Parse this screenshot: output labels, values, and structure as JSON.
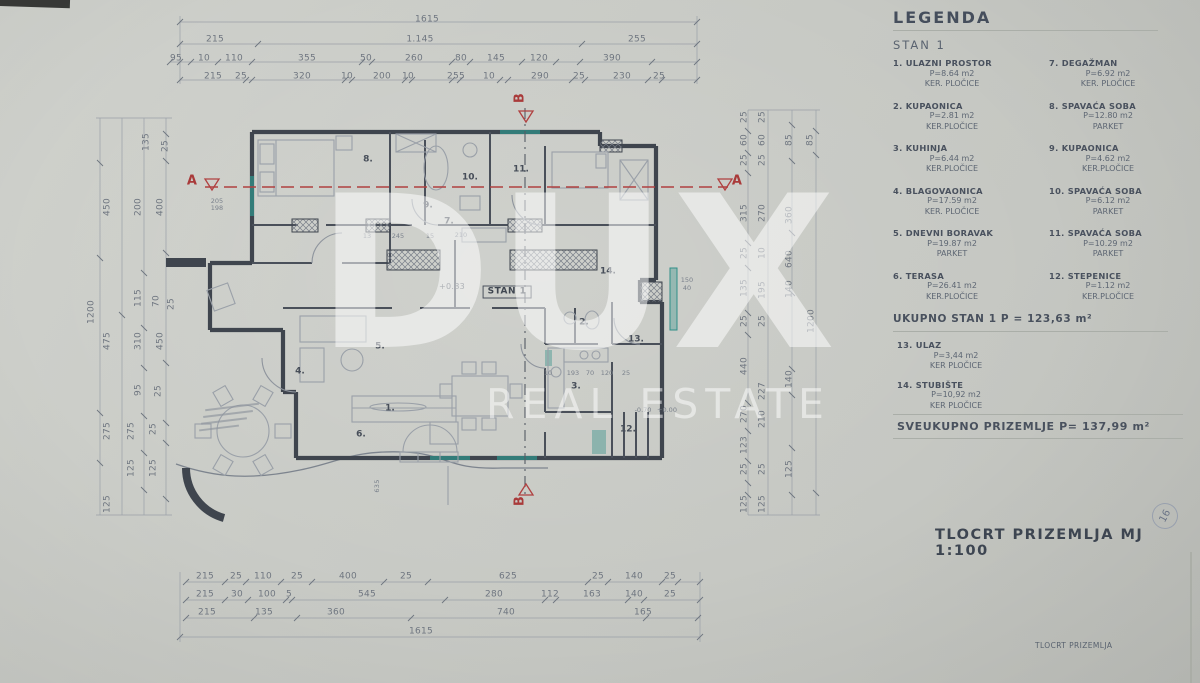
{
  "colors": {
    "paper": "#c9cbc6",
    "ink": "#3f454e",
    "dim_text": "#6f7680",
    "section_red": "#a93a3a",
    "highlight_teal": "#2f8f88",
    "watermark_white": "rgba(255,255,255,0.52)"
  },
  "watermark": {
    "line1": "DUX",
    "line2": "REAL ESTATE"
  },
  "legend": {
    "title": "LEGENDA",
    "subtitle": "STAN 1",
    "items": [
      {
        "num": "1.",
        "name": "ULAZNI PROSTOR",
        "area": "P=8.64 m2",
        "floor": "KER. PLOČICE"
      },
      {
        "num": "7.",
        "name": "DEGAŽMAN",
        "area": "P=6.92 m2",
        "floor": "KER. PLOČICE"
      },
      {
        "num": "2.",
        "name": "KUPAONICA",
        "area": "P=2.81 m2",
        "floor": "KER.PLOČICE"
      },
      {
        "num": "8.",
        "name": "SPAVAĆA SOBA",
        "area": "P=12.80 m2",
        "floor": "PARKET"
      },
      {
        "num": "3.",
        "name": "KUHINJA",
        "area": "P=6.44 m2",
        "floor": "KER.PLOČICE"
      },
      {
        "num": "9.",
        "name": "KUPAONICA",
        "area": "P=4.62 m2",
        "floor": "KER.PLOČICE"
      },
      {
        "num": "4.",
        "name": "BLAGOVAONICA",
        "area": "P=17.59 m2",
        "floor": "KER. PLOČICE"
      },
      {
        "num": "10.",
        "name": "SPAVAĆA SOBA",
        "area": "P=6.12 m2",
        "floor": "PARKET"
      },
      {
        "num": "5.",
        "name": "DNEVNI BORAVAK",
        "area": "P=19.87 m2",
        "floor": "PARKET"
      },
      {
        "num": "11.",
        "name": "SPAVAĆA SOBA",
        "area": "P=10.29 m2",
        "floor": "PARKET"
      },
      {
        "num": "6.",
        "name": "TERASA",
        "area": "P=26.41 m2",
        "floor": "KER.PLOČICE"
      },
      {
        "num": "12.",
        "name": "STEPENICE",
        "area": "P=1.12 m2",
        "floor": "KER.PLOČICE"
      }
    ],
    "total_stan": "UKUPNO  STAN 1  P = 123,63 m²",
    "extra_items": [
      {
        "num": "13.",
        "name": "ULAZ",
        "area": "P=3,44 m2",
        "floor": "KER PLOČICE"
      },
      {
        "num": "14.",
        "name": "STUBIŠTE",
        "area": "P=10,92 m2",
        "floor": "KER PLOČICE"
      }
    ],
    "total_ground": "SVEUKUPNO  PRIZEMLJE  P= 137,99 m²"
  },
  "titles": {
    "main": "TLOCRT  PRIZEMLJA  MJ  1:100",
    "footer": "TLOCRT PRIZEMLJA",
    "page_number": "16"
  },
  "plan": {
    "texts": [
      {
        "t": "1615",
        "x": 427,
        "y": 20,
        "c": "d"
      },
      {
        "t": "215",
        "x": 215,
        "y": 40,
        "c": "d"
      },
      {
        "t": "1.145",
        "x": 420,
        "y": 40,
        "c": "d"
      },
      {
        "t": "255",
        "x": 637,
        "y": 40,
        "c": "d"
      },
      {
        "t": "95",
        "x": 176,
        "y": 59,
        "c": "d"
      },
      {
        "t": "10",
        "x": 204,
        "y": 59,
        "c": "d"
      },
      {
        "t": "110",
        "x": 234,
        "y": 59,
        "c": "d"
      },
      {
        "t": "355",
        "x": 307,
        "y": 59,
        "c": "d"
      },
      {
        "t": "50",
        "x": 366,
        "y": 59,
        "c": "d"
      },
      {
        "t": "260",
        "x": 414,
        "y": 59,
        "c": "d"
      },
      {
        "t": "80",
        "x": 461,
        "y": 59,
        "c": "d"
      },
      {
        "t": "145",
        "x": 496,
        "y": 59,
        "c": "d"
      },
      {
        "t": "120",
        "x": 539,
        "y": 59,
        "c": "d"
      },
      {
        "t": "390",
        "x": 612,
        "y": 59,
        "c": "d"
      },
      {
        "t": "215",
        "x": 213,
        "y": 77,
        "c": "d"
      },
      {
        "t": "25",
        "x": 241,
        "y": 77,
        "c": "d"
      },
      {
        "t": "320",
        "x": 302,
        "y": 77,
        "c": "d"
      },
      {
        "t": "10",
        "x": 347,
        "y": 77,
        "c": "d"
      },
      {
        "t": "200",
        "x": 382,
        "y": 77,
        "c": "d"
      },
      {
        "t": "10",
        "x": 408,
        "y": 77,
        "c": "d"
      },
      {
        "t": "255",
        "x": 456,
        "y": 77,
        "c": "d"
      },
      {
        "t": "10",
        "x": 489,
        "y": 77,
        "c": "d"
      },
      {
        "t": "290",
        "x": 540,
        "y": 77,
        "c": "d"
      },
      {
        "t": "25",
        "x": 579,
        "y": 77,
        "c": "d"
      },
      {
        "t": "230",
        "x": 622,
        "y": 77,
        "c": "d"
      },
      {
        "t": "25",
        "x": 659,
        "y": 77,
        "c": "d"
      },
      {
        "t": "215",
        "x": 205,
        "y": 577,
        "c": "d"
      },
      {
        "t": "25",
        "x": 236,
        "y": 577,
        "c": "d"
      },
      {
        "t": "110",
        "x": 263,
        "y": 577,
        "c": "d"
      },
      {
        "t": "25",
        "x": 297,
        "y": 577,
        "c": "d"
      },
      {
        "t": "400",
        "x": 348,
        "y": 577,
        "c": "d"
      },
      {
        "t": "25",
        "x": 406,
        "y": 577,
        "c": "d"
      },
      {
        "t": "625",
        "x": 508,
        "y": 577,
        "c": "d"
      },
      {
        "t": "25",
        "x": 598,
        "y": 577,
        "c": "d"
      },
      {
        "t": "140",
        "x": 634,
        "y": 577,
        "c": "d"
      },
      {
        "t": "25",
        "x": 670,
        "y": 577,
        "c": "d"
      },
      {
        "t": "215",
        "x": 205,
        "y": 595,
        "c": "d"
      },
      {
        "t": "30",
        "x": 237,
        "y": 595,
        "c": "d"
      },
      {
        "t": "100",
        "x": 267,
        "y": 595,
        "c": "d"
      },
      {
        "t": "5",
        "x": 289,
        "y": 595,
        "c": "d"
      },
      {
        "t": "545",
        "x": 367,
        "y": 595,
        "c": "d"
      },
      {
        "t": "280",
        "x": 494,
        "y": 595,
        "c": "d"
      },
      {
        "t": "112",
        "x": 550,
        "y": 595,
        "c": "d"
      },
      {
        "t": "163",
        "x": 592,
        "y": 595,
        "c": "d"
      },
      {
        "t": "140",
        "x": 634,
        "y": 595,
        "c": "d"
      },
      {
        "t": "25",
        "x": 670,
        "y": 595,
        "c": "d"
      },
      {
        "t": "215",
        "x": 207,
        "y": 613,
        "c": "d"
      },
      {
        "t": "135",
        "x": 264,
        "y": 613,
        "c": "d"
      },
      {
        "t": "360",
        "x": 336,
        "y": 613,
        "c": "d"
      },
      {
        "t": "740",
        "x": 506,
        "y": 613,
        "c": "d"
      },
      {
        "t": "165",
        "x": 643,
        "y": 613,
        "c": "d"
      },
      {
        "t": "1615",
        "x": 421,
        "y": 632,
        "c": "d"
      },
      {
        "t": "135",
        "x": 147,
        "y": 142,
        "c": "v"
      },
      {
        "t": "25",
        "x": 166,
        "y": 146,
        "c": "v"
      },
      {
        "t": "450",
        "x": 108,
        "y": 207,
        "c": "v"
      },
      {
        "t": "200",
        "x": 139,
        "y": 207,
        "c": "v"
      },
      {
        "t": "400",
        "x": 161,
        "y": 207,
        "c": "v"
      },
      {
        "t": "115",
        "x": 139,
        "y": 298,
        "c": "v"
      },
      {
        "t": "70",
        "x": 157,
        "y": 301,
        "c": "v"
      },
      {
        "t": "25",
        "x": 172,
        "y": 304,
        "c": "v"
      },
      {
        "t": "1200",
        "x": 92,
        "y": 312,
        "c": "v"
      },
      {
        "t": "475",
        "x": 108,
        "y": 341,
        "c": "v"
      },
      {
        "t": "310",
        "x": 139,
        "y": 341,
        "c": "v"
      },
      {
        "t": "450",
        "x": 161,
        "y": 341,
        "c": "v"
      },
      {
        "t": "95",
        "x": 139,
        "y": 390,
        "c": "v"
      },
      {
        "t": "25",
        "x": 159,
        "y": 391,
        "c": "v"
      },
      {
        "t": "275",
        "x": 108,
        "y": 431,
        "c": "v"
      },
      {
        "t": "275",
        "x": 132,
        "y": 431,
        "c": "v"
      },
      {
        "t": "25",
        "x": 154,
        "y": 429,
        "c": "v"
      },
      {
        "t": "125",
        "x": 132,
        "y": 468,
        "c": "v"
      },
      {
        "t": "125",
        "x": 154,
        "y": 468,
        "c": "v"
      },
      {
        "t": "125",
        "x": 108,
        "y": 504,
        "c": "v"
      },
      {
        "t": "25",
        "x": 745,
        "y": 117,
        "c": "v"
      },
      {
        "t": "60",
        "x": 745,
        "y": 140,
        "c": "v"
      },
      {
        "t": "25",
        "x": 745,
        "y": 160,
        "c": "v"
      },
      {
        "t": "25",
        "x": 763,
        "y": 117,
        "c": "v"
      },
      {
        "t": "60",
        "x": 763,
        "y": 140,
        "c": "v"
      },
      {
        "t": "25",
        "x": 763,
        "y": 160,
        "c": "v"
      },
      {
        "t": "85",
        "x": 790,
        "y": 140,
        "c": "v"
      },
      {
        "t": "85",
        "x": 811,
        "y": 140,
        "c": "v"
      },
      {
        "t": "315",
        "x": 745,
        "y": 213,
        "c": "v"
      },
      {
        "t": "270",
        "x": 763,
        "y": 213,
        "c": "v"
      },
      {
        "t": "360",
        "x": 790,
        "y": 215,
        "c": "v"
      },
      {
        "t": "25",
        "x": 745,
        "y": 253,
        "c": "v"
      },
      {
        "t": "10",
        "x": 763,
        "y": 253,
        "c": "v"
      },
      {
        "t": "640",
        "x": 790,
        "y": 259,
        "c": "v"
      },
      {
        "t": "135",
        "x": 745,
        "y": 288,
        "c": "v"
      },
      {
        "t": "195",
        "x": 763,
        "y": 290,
        "c": "v"
      },
      {
        "t": "140",
        "x": 790,
        "y": 289,
        "c": "v"
      },
      {
        "t": "25",
        "x": 745,
        "y": 321,
        "c": "v"
      },
      {
        "t": "25",
        "x": 763,
        "y": 321,
        "c": "v"
      },
      {
        "t": "1200",
        "x": 812,
        "y": 321,
        "c": "v"
      },
      {
        "t": "440",
        "x": 745,
        "y": 366,
        "c": "v"
      },
      {
        "t": "227",
        "x": 763,
        "y": 391,
        "c": "v"
      },
      {
        "t": "140",
        "x": 790,
        "y": 379,
        "c": "v"
      },
      {
        "t": "270",
        "x": 745,
        "y": 414,
        "c": "v"
      },
      {
        "t": "210",
        "x": 763,
        "y": 419,
        "c": "v"
      },
      {
        "t": "123",
        "x": 745,
        "y": 445,
        "c": "v"
      },
      {
        "t": "25",
        "x": 745,
        "y": 469,
        "c": "v"
      },
      {
        "t": "25",
        "x": 763,
        "y": 469,
        "c": "v"
      },
      {
        "t": "125",
        "x": 790,
        "y": 469,
        "c": "v"
      },
      {
        "t": "125",
        "x": 745,
        "y": 504,
        "c": "v"
      },
      {
        "t": "125",
        "x": 763,
        "y": 504,
        "c": "v"
      },
      {
        "t": "8.",
        "x": 368,
        "y": 160,
        "c": "r"
      },
      {
        "t": "9.",
        "x": 428,
        "y": 206,
        "c": "r"
      },
      {
        "t": "10.",
        "x": 470,
        "y": 178,
        "c": "r"
      },
      {
        "t": "11.",
        "x": 521,
        "y": 170,
        "c": "r"
      },
      {
        "t": "7.",
        "x": 449,
        "y": 222,
        "c": "r"
      },
      {
        "t": "14.",
        "x": 608,
        "y": 272,
        "c": "r"
      },
      {
        "t": "13.",
        "x": 636,
        "y": 340,
        "c": "r"
      },
      {
        "t": "2.",
        "x": 584,
        "y": 323,
        "c": "r"
      },
      {
        "t": "5.",
        "x": 380,
        "y": 347,
        "c": "r"
      },
      {
        "t": "3.",
        "x": 576,
        "y": 387,
        "c": "r"
      },
      {
        "t": "4.",
        "x": 300,
        "y": 372,
        "c": "r"
      },
      {
        "t": "1.",
        "x": 390,
        "y": 409,
        "c": "r"
      },
      {
        "t": "6.",
        "x": 361,
        "y": 435,
        "c": "r"
      },
      {
        "t": "12.",
        "x": 628,
        "y": 430,
        "c": "r"
      },
      {
        "t": "STAN 1",
        "x": 507,
        "y": 292,
        "c": "s"
      },
      {
        "t": "+0.83",
        "x": 452,
        "y": 287,
        "c": "l"
      },
      {
        "t": "150",
        "x": 687,
        "y": 280,
        "c": "t"
      },
      {
        "t": "40",
        "x": 687,
        "y": 288,
        "c": "t"
      },
      {
        "t": "-0.70",
        "x": 643,
        "y": 410,
        "c": "t"
      },
      {
        "t": "+0.00",
        "x": 667,
        "y": 410,
        "c": "t"
      },
      {
        "t": "205",
        "x": 217,
        "y": 201,
        "c": "t"
      },
      {
        "t": "198",
        "x": 217,
        "y": 208,
        "c": "t"
      },
      {
        "t": "13",
        "x": 367,
        "y": 236,
        "c": "t"
      },
      {
        "t": "245",
        "x": 398,
        "y": 236,
        "c": "t"
      },
      {
        "t": "15",
        "x": 430,
        "y": 236,
        "c": "t"
      },
      {
        "t": "210",
        "x": 461,
        "y": 235,
        "c": "t"
      },
      {
        "t": "10",
        "x": 548,
        "y": 373,
        "c": "t"
      },
      {
        "t": "193",
        "x": 573,
        "y": 373,
        "c": "t"
      },
      {
        "t": "70",
        "x": 590,
        "y": 373,
        "c": "t"
      },
      {
        "t": "120",
        "x": 607,
        "y": 373,
        "c": "t"
      },
      {
        "t": "25",
        "x": 626,
        "y": 373,
        "c": "t"
      },
      {
        "t": "635",
        "x": 377,
        "y": 486,
        "c": "tv"
      },
      {
        "t": "A",
        "x": 192,
        "y": 181,
        "c": "A"
      },
      {
        "t": "A",
        "x": 737,
        "y": 181,
        "c": "A"
      },
      {
        "t": "B",
        "x": 520,
        "y": 98,
        "c": "Av"
      },
      {
        "t": "B",
        "x": 520,
        "y": 501,
        "c": "Av"
      }
    ]
  }
}
